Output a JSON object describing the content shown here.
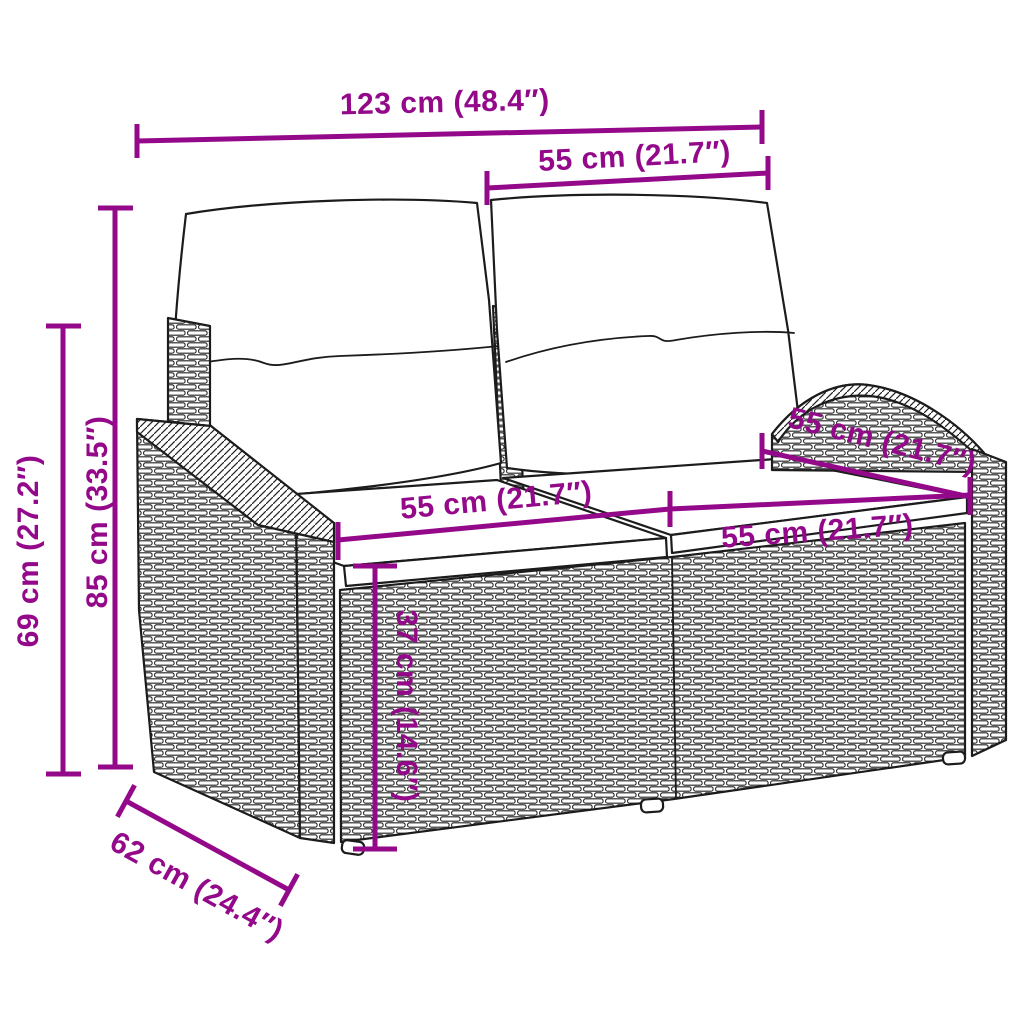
{
  "colors": {
    "accent": "#93098a",
    "line": "#1c1c1c",
    "background": "#ffffff"
  },
  "dimensions": [
    {
      "id": "total-width",
      "label": "123 cm (48.4″)"
    },
    {
      "id": "backrest-width",
      "label": "55 cm (21.7″)"
    },
    {
      "id": "back-height",
      "label": "85 cm (33.5″)"
    },
    {
      "id": "arm-height",
      "label": "69 cm (27.2″)"
    },
    {
      "id": "seat-width-left",
      "label": "55 cm (21.7″)"
    },
    {
      "id": "seat-width-right",
      "label": "55 cm (21.7″)"
    },
    {
      "id": "seat-depth",
      "label": "55 cm (21.7″)"
    },
    {
      "id": "seat-height",
      "label": "37 cm (14.6″)"
    },
    {
      "id": "overall-depth",
      "label": "62 cm (24.4″)"
    }
  ]
}
